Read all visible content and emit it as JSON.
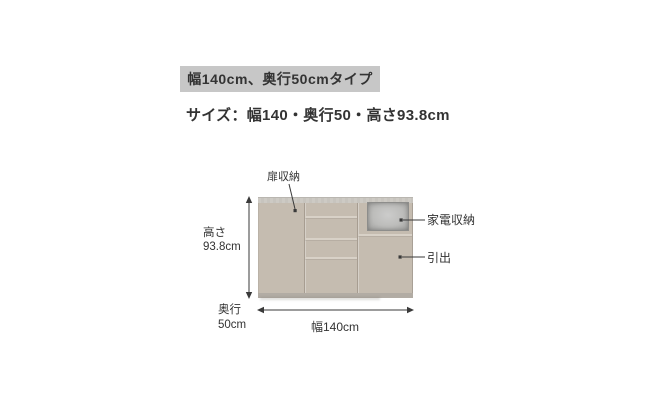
{
  "header": {
    "type_badge": "幅140cm、奥行50cmタイプ",
    "size_line": "サイズ：幅140・奥行50・高さ93.8cm"
  },
  "diagram": {
    "door_storage_label": "扉収納",
    "appliance_storage_label": "家電収納",
    "drawer_label": "引出",
    "height": {
      "label": "高さ",
      "value": "93.8cm"
    },
    "depth": {
      "label": "奥行",
      "value": "50cm"
    },
    "width": {
      "value": "幅140cm"
    }
  },
  "colors": {
    "badge_bg": "#c7c7c7",
    "text": "#333333",
    "cabinet_body": "#c5bcb0",
    "counter": "#cdcac4",
    "groove": "#d8d1c7",
    "base": "#b2aca4",
    "opening_border": "#8d8d8b",
    "dimension_line": "#3a3a3a"
  }
}
